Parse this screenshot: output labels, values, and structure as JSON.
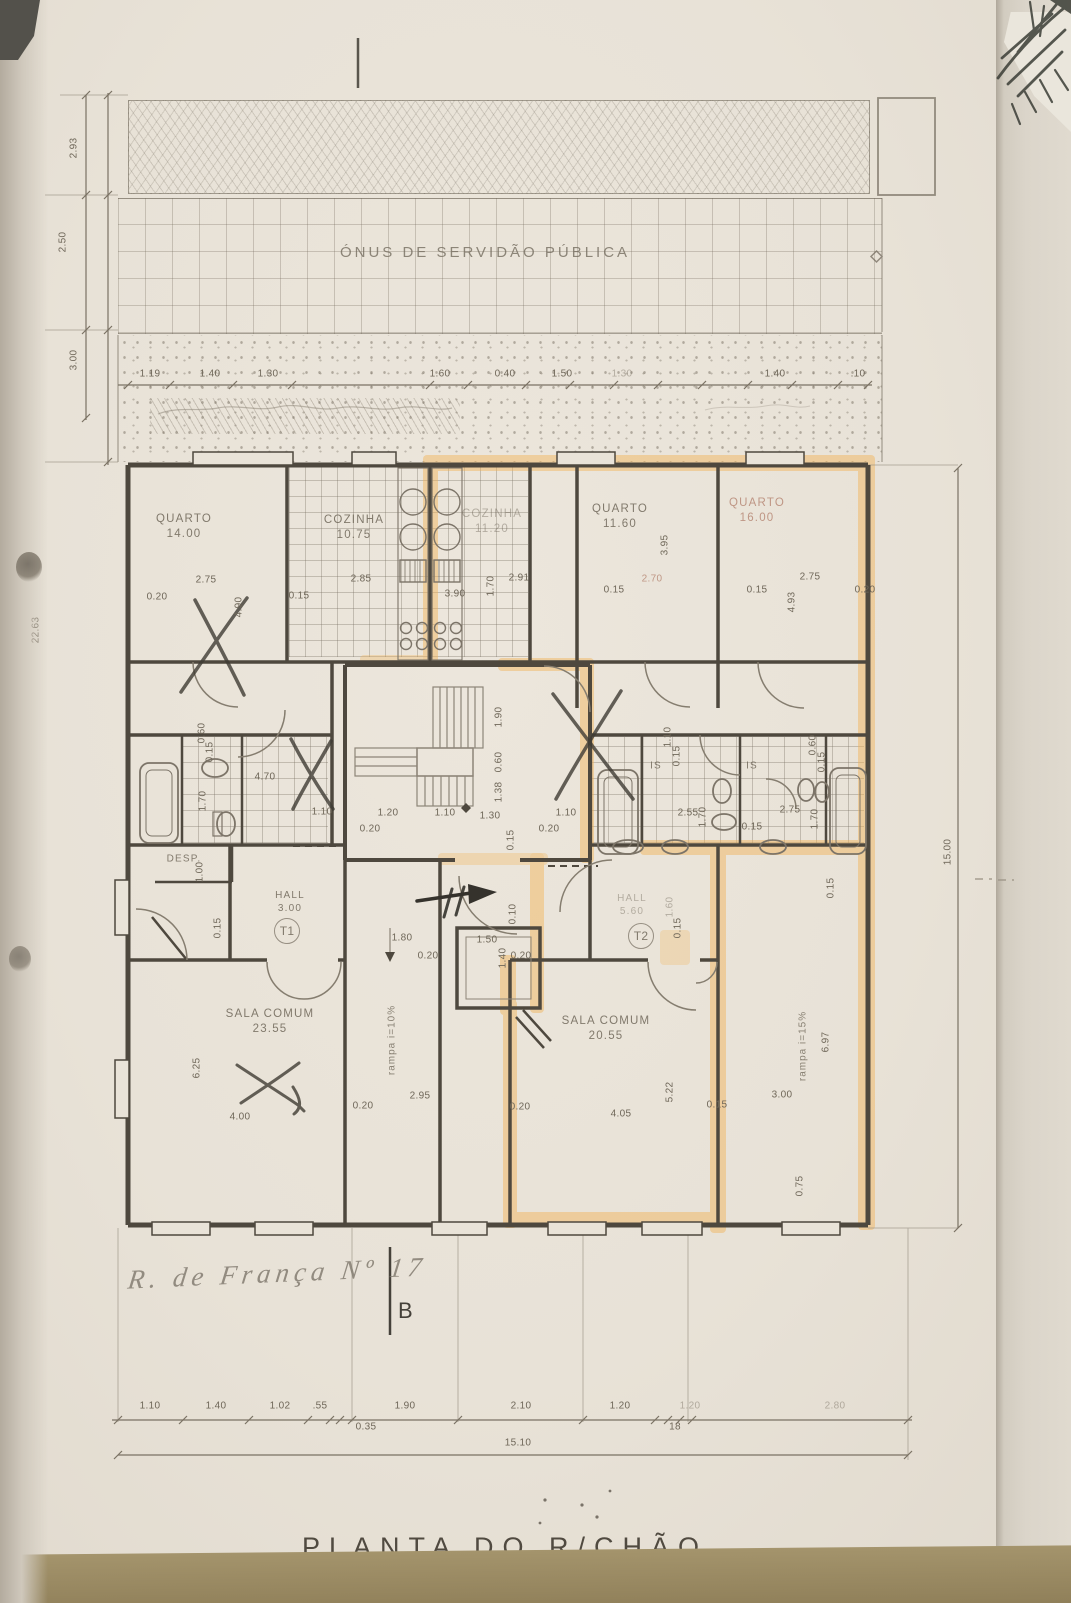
{
  "document": {
    "plan_title": "PLANTA DO R/CHÃO",
    "address_note": "R. de França Nº 17",
    "section_marker": "B"
  },
  "plan": {
    "servitude_text": "ÓNUS DE SERVIDÃO PÚBLICA",
    "units": [
      "T1",
      "T2"
    ],
    "labels": [
      {
        "t": "QUARTO\n14.00",
        "x": 184,
        "y": 527,
        "k": "room"
      },
      {
        "t": "COZINHA\n10.75",
        "x": 354,
        "y": 528,
        "k": "room"
      },
      {
        "t": "COZINHA\n11.20",
        "x": 492,
        "y": 522,
        "k": "room faint"
      },
      {
        "t": "QUARTO\n11.60",
        "x": 620,
        "y": 517,
        "k": "room"
      },
      {
        "t": "QUARTO\n16.00",
        "x": 757,
        "y": 511,
        "k": "room red"
      },
      {
        "t": "SALA COMUM\n23.55",
        "x": 270,
        "y": 1022,
        "k": "room"
      },
      {
        "t": "SALA COMUM\n20.55",
        "x": 606,
        "y": 1029,
        "k": "room"
      },
      {
        "t": "HALL\n3.00",
        "x": 290,
        "y": 902,
        "k": "room sm"
      },
      {
        "t": "HALL\n5.60",
        "x": 632,
        "y": 905,
        "k": "room sm faint"
      },
      {
        "t": "DESP.",
        "x": 184,
        "y": 859,
        "k": "room sm"
      },
      {
        "t": "IS",
        "x": 656,
        "y": 766,
        "k": "room sm"
      },
      {
        "t": "IS",
        "x": 752,
        "y": 766,
        "k": "room sm"
      },
      {
        "t": "T1",
        "x": 287,
        "y": 931,
        "k": "unit"
      },
      {
        "t": "T2",
        "x": 641,
        "y": 936,
        "k": "unit"
      },
      {
        "t": "rampa  i=10%",
        "x": 392,
        "y": 1040,
        "r": -90,
        "k": "note"
      },
      {
        "t": "rampa  i=15%",
        "x": 803,
        "y": 1046,
        "r": -90,
        "k": "note"
      },
      {
        "t": "1.19",
        "x": 150,
        "y": 374
      },
      {
        "t": "1.40",
        "x": 210,
        "y": 374
      },
      {
        "t": "1.30",
        "x": 268,
        "y": 374
      },
      {
        "t": "1.60",
        "x": 440,
        "y": 374
      },
      {
        "t": "0.40",
        "x": 505,
        "y": 374
      },
      {
        "t": "1.50",
        "x": 562,
        "y": 374
      },
      {
        "t": "1.30",
        "x": 622,
        "y": 374,
        "k": "dim faint"
      },
      {
        "t": "1.40",
        "x": 775,
        "y": 374
      },
      {
        "t": ".10",
        "x": 858,
        "y": 374
      },
      {
        "t": "0.20",
        "x": 157,
        "y": 597
      },
      {
        "t": "2.75",
        "x": 206,
        "y": 580
      },
      {
        "t": "0.15",
        "x": 299,
        "y": 596
      },
      {
        "t": "2.85",
        "x": 361,
        "y": 579
      },
      {
        "t": "3.90",
        "x": 455,
        "y": 594
      },
      {
        "t": "2.91",
        "x": 519,
        "y": 578
      },
      {
        "t": "0.15",
        "x": 614,
        "y": 590
      },
      {
        "t": "2.70",
        "x": 652,
        "y": 579,
        "k": "dim red"
      },
      {
        "t": "0.15",
        "x": 757,
        "y": 590
      },
      {
        "t": "2.75",
        "x": 810,
        "y": 577
      },
      {
        "t": "0.20",
        "x": 865,
        "y": 590
      },
      {
        "t": "4.90",
        "x": 239,
        "y": 607,
        "r": -90
      },
      {
        "t": "1.70",
        "x": 491,
        "y": 586,
        "r": -90
      },
      {
        "t": "3.95",
        "x": 665,
        "y": 545,
        "r": -90
      },
      {
        "t": "4.93",
        "x": 792,
        "y": 602,
        "r": -90
      },
      {
        "t": "2.93",
        "x": 74,
        "y": 148,
        "r": -90
      },
      {
        "t": "2.50",
        "x": 63,
        "y": 242,
        "r": -90
      },
      {
        "t": "3.00",
        "x": 74,
        "y": 360,
        "r": -90
      },
      {
        "t": "22.63",
        "x": 36,
        "y": 630,
        "r": -90
      },
      {
        "t": "15.00",
        "x": 948,
        "y": 852,
        "r": -90
      },
      {
        "t": "0.60",
        "x": 202,
        "y": 733,
        "r": -90
      },
      {
        "t": "0.15",
        "x": 210,
        "y": 752,
        "r": -90
      },
      {
        "t": "4.70",
        "x": 265,
        "y": 777
      },
      {
        "t": "1.70",
        "x": 203,
        "y": 801,
        "r": -90
      },
      {
        "t": "1.90",
        "x": 499,
        "y": 717,
        "r": -90
      },
      {
        "t": "0.60",
        "x": 499,
        "y": 762,
        "r": -90
      },
      {
        "t": "1.38",
        "x": 499,
        "y": 792,
        "r": -90
      },
      {
        "t": "0.15",
        "x": 511,
        "y": 840,
        "r": -90
      },
      {
        "t": "1.10",
        "x": 322,
        "y": 812
      },
      {
        "t": "1.20",
        "x": 388,
        "y": 813
      },
      {
        "t": "1.10",
        "x": 445,
        "y": 813
      },
      {
        "t": "1.30",
        "x": 490,
        "y": 816
      },
      {
        "t": "1.10",
        "x": 566,
        "y": 813
      },
      {
        "t": "0.20",
        "x": 370,
        "y": 829
      },
      {
        "t": "0.20",
        "x": 549,
        "y": 829
      },
      {
        "t": "1.10",
        "x": 668,
        "y": 737,
        "r": -90
      },
      {
        "t": "0.15",
        "x": 677,
        "y": 756,
        "r": -90
      },
      {
        "t": "0.60",
        "x": 813,
        "y": 745,
        "r": -90
      },
      {
        "t": "0.15",
        "x": 822,
        "y": 762,
        "r": -90
      },
      {
        "t": "2.55",
        "x": 688,
        "y": 813
      },
      {
        "t": "1.70",
        "x": 703,
        "y": 817,
        "r": -90
      },
      {
        "t": "2.75",
        "x": 790,
        "y": 810
      },
      {
        "t": "1.70",
        "x": 815,
        "y": 819,
        "r": -90
      },
      {
        "t": "0.15",
        "x": 752,
        "y": 827
      },
      {
        "t": "1.00",
        "x": 200,
        "y": 872,
        "r": -90
      },
      {
        "t": "0.15",
        "x": 218,
        "y": 928,
        "r": -90
      },
      {
        "t": "1.80",
        "x": 402,
        "y": 938
      },
      {
        "t": "0.20",
        "x": 428,
        "y": 956
      },
      {
        "t": "1.50",
        "x": 487,
        "y": 940
      },
      {
        "t": "1.40",
        "x": 503,
        "y": 958,
        "r": -90
      },
      {
        "t": "0.20",
        "x": 521,
        "y": 956
      },
      {
        "t": "0.10",
        "x": 513,
        "y": 914,
        "r": -90
      },
      {
        "t": "1.60",
        "x": 670,
        "y": 907,
        "r": -90,
        "k": "dim faint"
      },
      {
        "t": "0.15",
        "x": 678,
        "y": 928,
        "r": -90
      },
      {
        "t": "0.15",
        "x": 831,
        "y": 888,
        "r": -90
      },
      {
        "t": "6.25",
        "x": 197,
        "y": 1068,
        "r": -90
      },
      {
        "t": "4.00",
        "x": 240,
        "y": 1117
      },
      {
        "t": "0.20",
        "x": 363,
        "y": 1106
      },
      {
        "t": "2.95",
        "x": 420,
        "y": 1096
      },
      {
        "t": "0.20",
        "x": 520,
        "y": 1107
      },
      {
        "t": "4.05",
        "x": 621,
        "y": 1114
      },
      {
        "t": "5.22",
        "x": 670,
        "y": 1092,
        "r": -90
      },
      {
        "t": "0.15",
        "x": 717,
        "y": 1105
      },
      {
        "t": "3.00",
        "x": 782,
        "y": 1095
      },
      {
        "t": "6.97",
        "x": 826,
        "y": 1042,
        "r": -90
      },
      {
        "t": "0.75",
        "x": 800,
        "y": 1186,
        "r": -90
      },
      {
        "t": "1.10",
        "x": 150,
        "y": 1406
      },
      {
        "t": "1.40",
        "x": 216,
        "y": 1406
      },
      {
        "t": "1.02",
        "x": 280,
        "y": 1406
      },
      {
        "t": ".55",
        "x": 320,
        "y": 1406
      },
      {
        "t": "1.90",
        "x": 405,
        "y": 1406
      },
      {
        "t": "2.10",
        "x": 521,
        "y": 1406
      },
      {
        "t": "1.20",
        "x": 620,
        "y": 1406
      },
      {
        "t": "1.20",
        "x": 690,
        "y": 1406,
        "k": "dim faint"
      },
      {
        "t": "2.80",
        "x": 835,
        "y": 1406,
        "k": "dim faint"
      },
      {
        "t": "0.35",
        "x": 366,
        "y": 1427
      },
      {
        "t": "18",
        "x": 675,
        "y": 1427
      },
      {
        "t": "15.10",
        "x": 518,
        "y": 1443
      }
    ],
    "dim_chains": [
      {
        "o": "h",
        "y": 385,
        "x1": 118,
        "x2": 872,
        "ticks": [
          128,
          170,
          233,
          292,
          430,
          468,
          526,
          570,
          614,
          658,
          702,
          748,
          792,
          838,
          868
        ]
      },
      {
        "o": "h",
        "y": 1420,
        "x1": 112,
        "x2": 912,
        "ticks": [
          118,
          183,
          249,
          308,
          330,
          340,
          352,
          458,
          583,
          655,
          668,
          680,
          692,
          908
        ]
      },
      {
        "o": "h",
        "y": 1455,
        "x1": 118,
        "x2": 908,
        "ticks": [
          118,
          908
        ]
      },
      {
        "o": "v",
        "x": 108,
        "y1": 93,
        "y2": 465,
        "ticks": [
          95,
          195,
          330,
          462
        ]
      },
      {
        "o": "v",
        "x": 86,
        "y1": 95,
        "y2": 420,
        "ticks": [
          95,
          195,
          330,
          418
        ]
      },
      {
        "o": "v",
        "x": 958,
        "y1": 468,
        "y2": 1228,
        "ticks": [
          468,
          1228
        ]
      }
    ]
  }
}
